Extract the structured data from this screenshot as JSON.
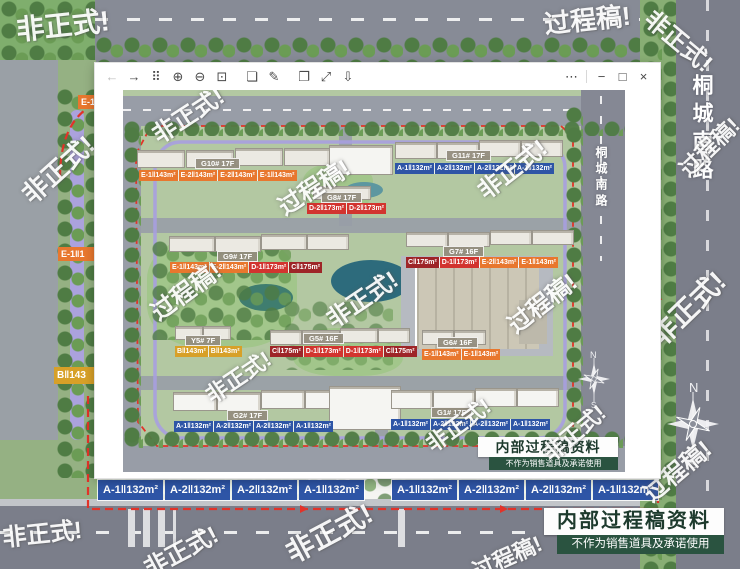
{
  "watermarks": {
    "unofficial": "非正式!",
    "draft": "过程稿!"
  },
  "viewer": {
    "toolbar": [
      {
        "name": "back",
        "glyph": "←"
      },
      {
        "name": "forward",
        "glyph": "→"
      },
      {
        "name": "thumbnails",
        "glyph": "⠿"
      },
      {
        "name": "zoom-in",
        "glyph": "⊕"
      },
      {
        "name": "zoom-out",
        "glyph": "⊖"
      },
      {
        "name": "actual-size",
        "glyph": "⊡"
      },
      {
        "name": "folder",
        "glyph": "❏"
      },
      {
        "name": "edit",
        "glyph": "✎"
      },
      {
        "name": "copy",
        "glyph": "❐"
      },
      {
        "name": "fullscreen",
        "glyph": "⤢"
      },
      {
        "name": "save",
        "glyph": "⇩"
      }
    ],
    "controls": [
      {
        "name": "more",
        "glyph": "⋯"
      },
      {
        "name": "minimize",
        "glyph": "−"
      },
      {
        "name": "maximize",
        "glyph": "□"
      },
      {
        "name": "close",
        "glyph": "×"
      }
    ]
  },
  "street": {
    "name": "桐城南路"
  },
  "compass": {
    "n": "N",
    "s": "S"
  },
  "notice": {
    "title": "内部过程稿资料",
    "subtitle": "不作为销售道具及承诺使用"
  },
  "unit_colors": {
    "blue_A": "#2e55a6",
    "orange_E": "#e8772e",
    "red_D": "#d2342f",
    "darkred_C": "#9e2528",
    "gold_B": "#d7a028"
  },
  "buildings": [
    {
      "name": "G10# 17F",
      "units": [
        {
          "t": "E-1‖143m²",
          "c": "o"
        },
        {
          "t": "E-2‖143m²",
          "c": "o"
        },
        {
          "t": "E-2‖143m²",
          "c": "o"
        },
        {
          "t": "E-1‖143m²",
          "c": "o"
        }
      ]
    },
    {
      "name": "G11# 17F",
      "units": [
        {
          "t": "A-1‖132m²",
          "c": "b"
        },
        {
          "t": "A-2‖132m²",
          "c": "b"
        },
        {
          "t": "A-2‖132m²",
          "c": "b"
        },
        {
          "t": "A-1‖132m²",
          "c": "b"
        }
      ]
    },
    {
      "name": "G8# 17F",
      "units": [
        {
          "t": "D-2‖173m²",
          "c": "r"
        },
        {
          "t": "D-2‖173m²",
          "c": "r"
        }
      ]
    },
    {
      "name": "G9# 17F",
      "units": [
        {
          "t": "E-1‖143m²",
          "c": "o"
        },
        {
          "t": "E-2‖143m²",
          "c": "o"
        },
        {
          "t": "D-1‖173m²",
          "c": "r"
        },
        {
          "t": "C‖175m²",
          "c": "dr"
        }
      ]
    },
    {
      "name": "G7# 16F",
      "units": [
        {
          "t": "C‖175m²",
          "c": "dr"
        },
        {
          "t": "D-1‖173m²",
          "c": "r"
        },
        {
          "t": "E-2‖143m²",
          "c": "o"
        },
        {
          "t": "E-1‖143m²",
          "c": "o"
        }
      ]
    },
    {
      "name": "Y5# 7F",
      "units": [
        {
          "t": "B‖143m²",
          "c": "g"
        },
        {
          "t": "B‖143m²",
          "c": "g"
        }
      ]
    },
    {
      "name": "G5# 16F",
      "units": [
        {
          "t": "C‖175m²",
          "c": "dr"
        },
        {
          "t": "D-1‖173m²",
          "c": "r"
        },
        {
          "t": "D-1‖173m²",
          "c": "r"
        },
        {
          "t": "C‖175m²",
          "c": "dr"
        }
      ]
    },
    {
      "name": "G6# 16F",
      "units": [
        {
          "t": "E-1‖143m²",
          "c": "o"
        },
        {
          "t": "E-1‖143m²",
          "c": "o"
        }
      ]
    },
    {
      "name": "G2# 17F",
      "units": [
        {
          "t": "A-1‖132m²",
          "c": "b"
        },
        {
          "t": "A-2‖132m²",
          "c": "b"
        },
        {
          "t": "A-2‖132m²",
          "c": "b"
        },
        {
          "t": "A-1‖132m²",
          "c": "b"
        }
      ]
    },
    {
      "name": "G1# 17F",
      "units": [
        {
          "t": "A-1‖132m²",
          "c": "b"
        },
        {
          "t": "A-2‖132m²",
          "c": "b"
        },
        {
          "t": "A-2‖132m²",
          "c": "b"
        },
        {
          "t": "A-1‖132m²",
          "c": "b"
        }
      ]
    }
  ],
  "edge_chips": {
    "left_top": "E-1",
    "left_mid": "E-1‖1",
    "left_bottom": "B‖143",
    "bottom_rows": [
      [
        {
          "t": "A-1‖132m²",
          "c": "b"
        },
        {
          "t": "A-2‖132m²",
          "c": "b"
        },
        {
          "t": "A-2‖132m²",
          "c": "b"
        },
        {
          "t": "A-1‖132m²",
          "c": "b"
        }
      ],
      [
        {
          "t": "A-1‖132m²",
          "c": "b"
        },
        {
          "t": "A-2‖132m²",
          "c": "b"
        },
        {
          "t": "A-2‖132m²",
          "c": "b"
        },
        {
          "t": "A-1‖132m²",
          "c": "b"
        }
      ]
    ]
  }
}
